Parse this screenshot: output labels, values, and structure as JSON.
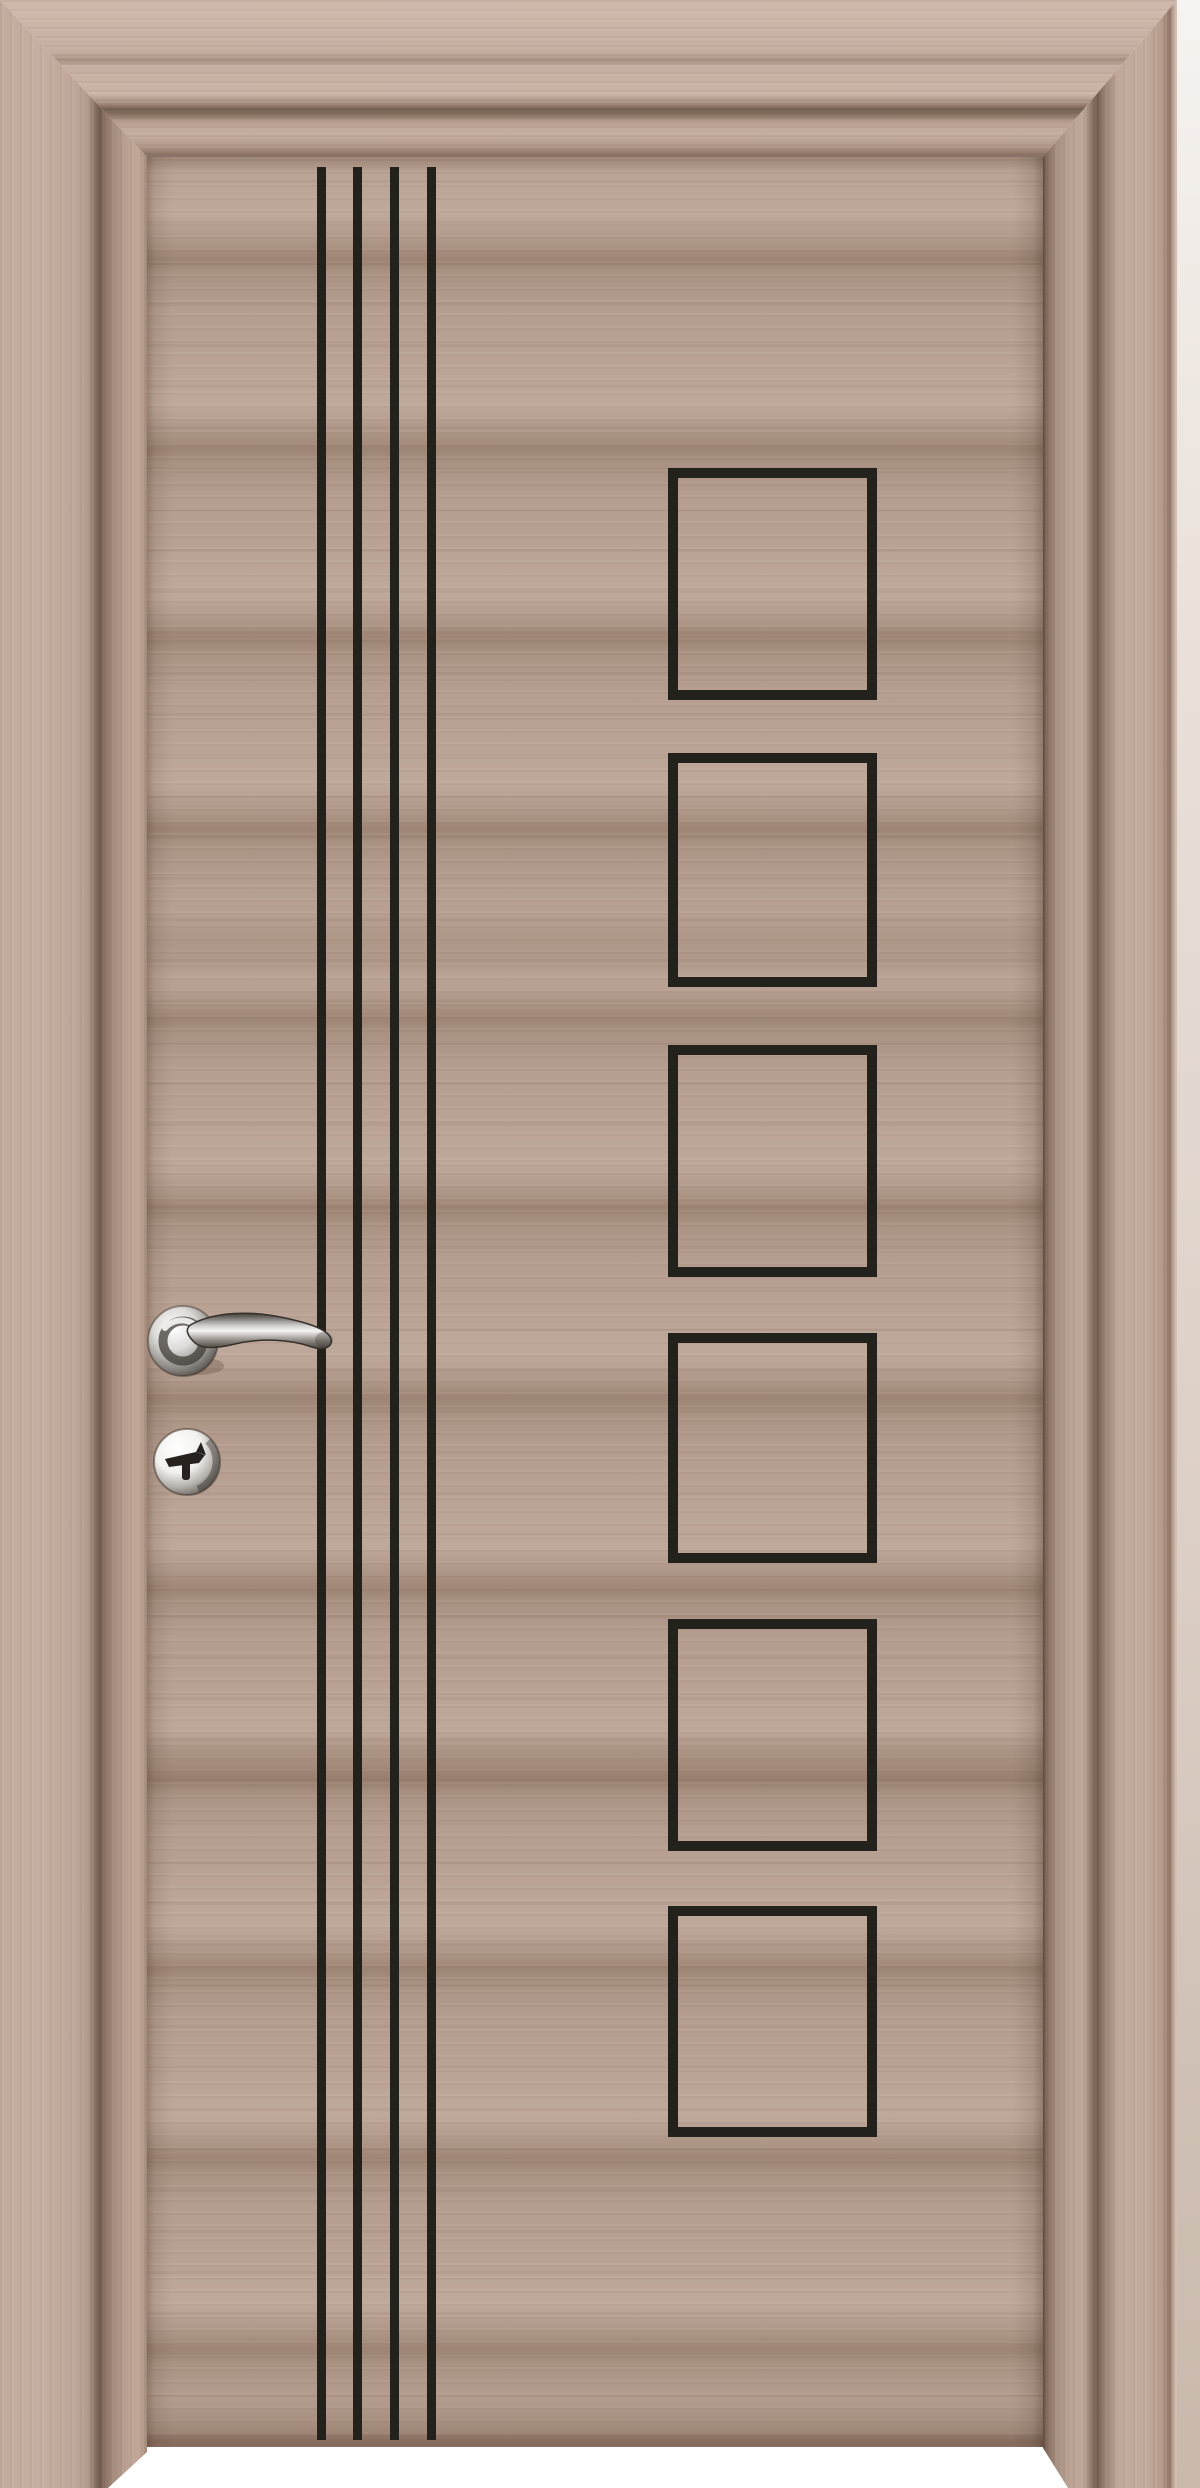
{
  "scene": {
    "description": "Product photo of an interior wooden door in light walnut finish with black inlay decoration, chrome lever handle and key cylinder, mounted in a matching wooden frame on a white background",
    "background_color": "#ffffff"
  },
  "frame": {
    "style": "wide flat casing with stepped molding and shadow groove, mitered corners",
    "color_light": "#cbb5a8",
    "color_groove": "#6f5a4d",
    "wall_strip_color": "#eae1da"
  },
  "door": {
    "finish": "light walnut / taupe horizontal wood grain",
    "base_color": "#b39b8d",
    "grain_dark": "#9d8474",
    "grain_light": "#bfa99b",
    "inlay_color": "#23211c",
    "vertical_lines": {
      "count": 4,
      "x_positions": [
        317,
        353,
        390,
        427
      ],
      "width": 9,
      "top": 167,
      "height": 2273
    },
    "squares": {
      "count": 6,
      "left": 668,
      "width": 209,
      "border_thickness": 10,
      "tops": [
        468,
        753,
        1045,
        1333,
        1619,
        1906
      ],
      "heights": [
        232,
        234,
        232,
        230,
        232,
        231
      ]
    }
  },
  "hardware": {
    "handle": "chrome lever handle on round rosette",
    "lock": "chrome round key cylinder escutcheon with dark keyhole",
    "chrome_light": "#f2f1ee",
    "chrome_dark": "#4a443f"
  }
}
